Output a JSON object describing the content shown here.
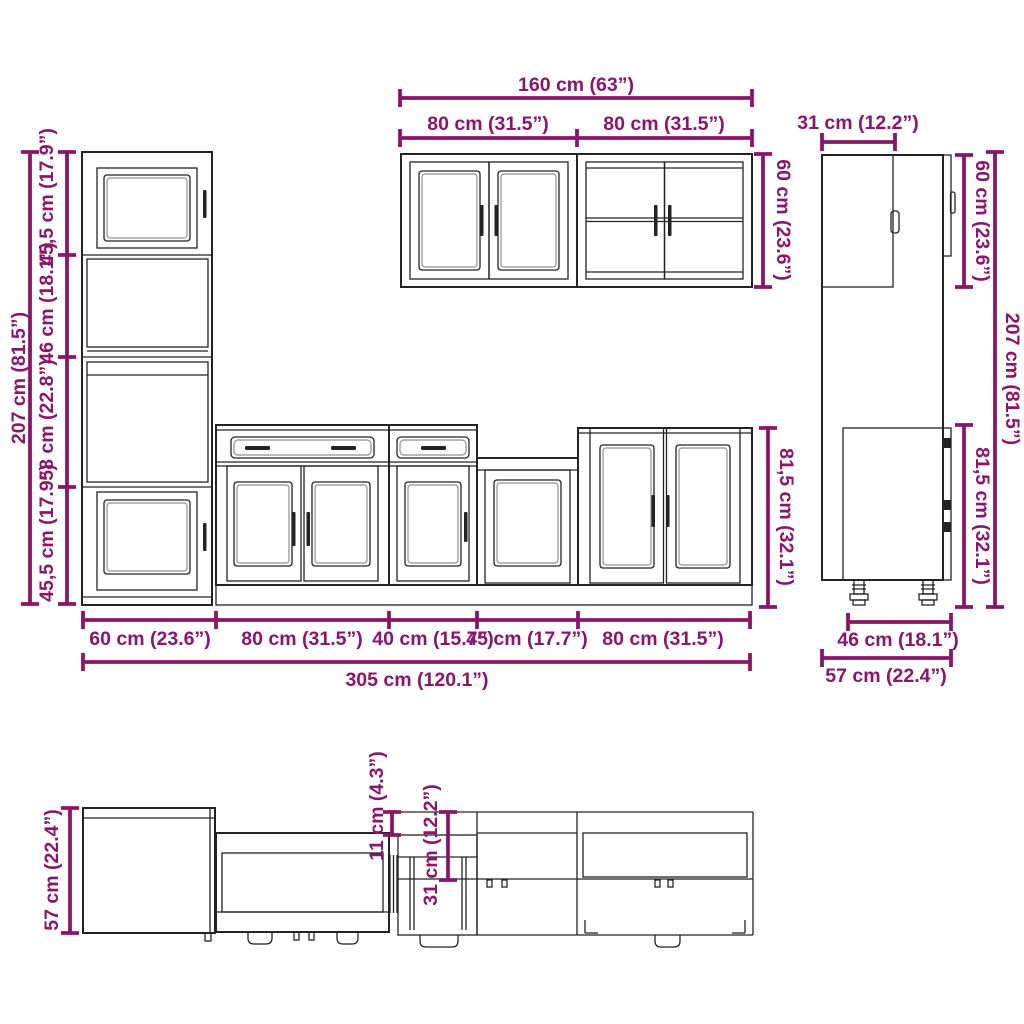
{
  "colors": {
    "dimension": "#8b156b",
    "line": "#232323",
    "background": "#ffffff"
  },
  "dims": {
    "tall": {
      "total": "207 cm (81.5”)",
      "sections": [
        "45,5 cm (17.9”)",
        "46 cm (18.1”)",
        "58 cm (22.8”)",
        "45,5 cm (17.9”)"
      ]
    },
    "wall": {
      "total_width": "160 cm (63”)",
      "left_width": "80 cm (31.5”)",
      "right_width": "80 cm (31.5”)",
      "height": "60 cm (23.6”)"
    },
    "base": {
      "height": "81,5 cm (32.1”)",
      "widths": [
        "60 cm (23.6”)",
        "80 cm (31.5”)",
        "40 cm (15.7”)",
        "45 cm (17.7”)",
        "80 cm (31.5”)"
      ],
      "total_width": "305 cm (120.1”)"
    },
    "side": {
      "wall_depth": "31 cm (12.2”)",
      "wall_height": "60 cm (23.6”)",
      "total_height": "207 cm (81.5”)",
      "base_height": "81,5 cm (32.1”)",
      "base_depth": "46 cm (18.1”)",
      "total_depth": "57 cm (22.4”)"
    },
    "plan": {
      "depth": "57 cm (22.4”)",
      "overhang": "11 cm (4.3”)",
      "wall_depth": "31 cm (12.2”)"
    }
  }
}
